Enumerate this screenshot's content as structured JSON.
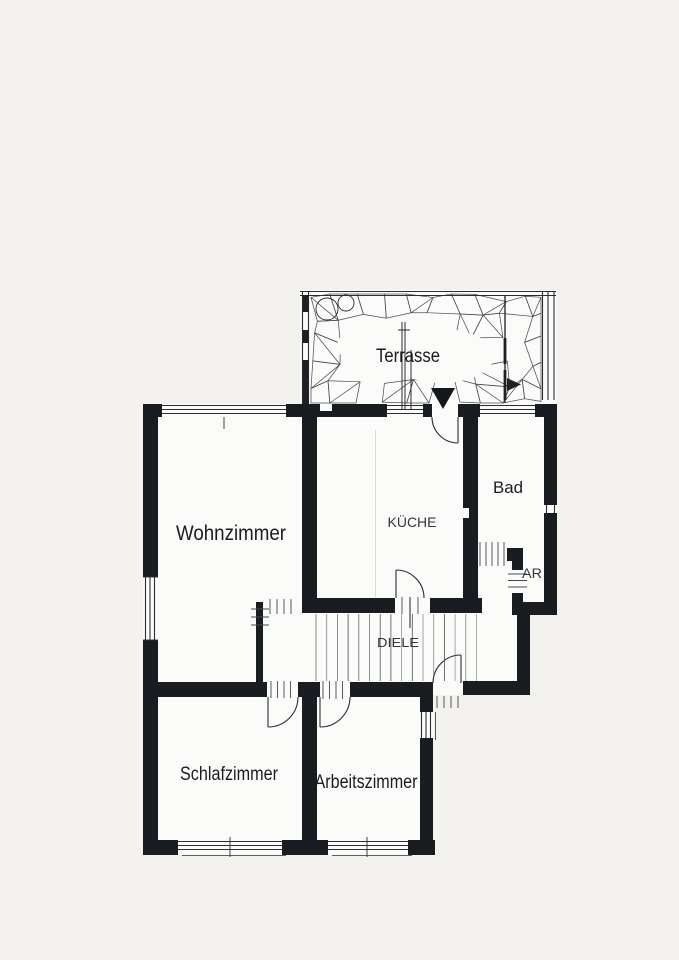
{
  "floorplan": {
    "rooms": [
      {
        "name": "terrasse",
        "label": "Terrasse"
      },
      {
        "name": "wohnzimmer",
        "label": "Wohnzimmer"
      },
      {
        "name": "kueche",
        "label": "KÜCHE"
      },
      {
        "name": "bad",
        "label": "Bad"
      },
      {
        "name": "abstellraum",
        "label": "AR"
      },
      {
        "name": "diele",
        "label": "DIELE"
      },
      {
        "name": "schlafzimmer",
        "label": "Schlafzimmer"
      },
      {
        "name": "arbeitszimmer",
        "label": "Arbeitszimmer"
      }
    ],
    "colors": {
      "ink": "#191c21",
      "line": "#2e3136",
      "paper": "#f3f2ef",
      "interior": "#fbfbfa"
    }
  }
}
